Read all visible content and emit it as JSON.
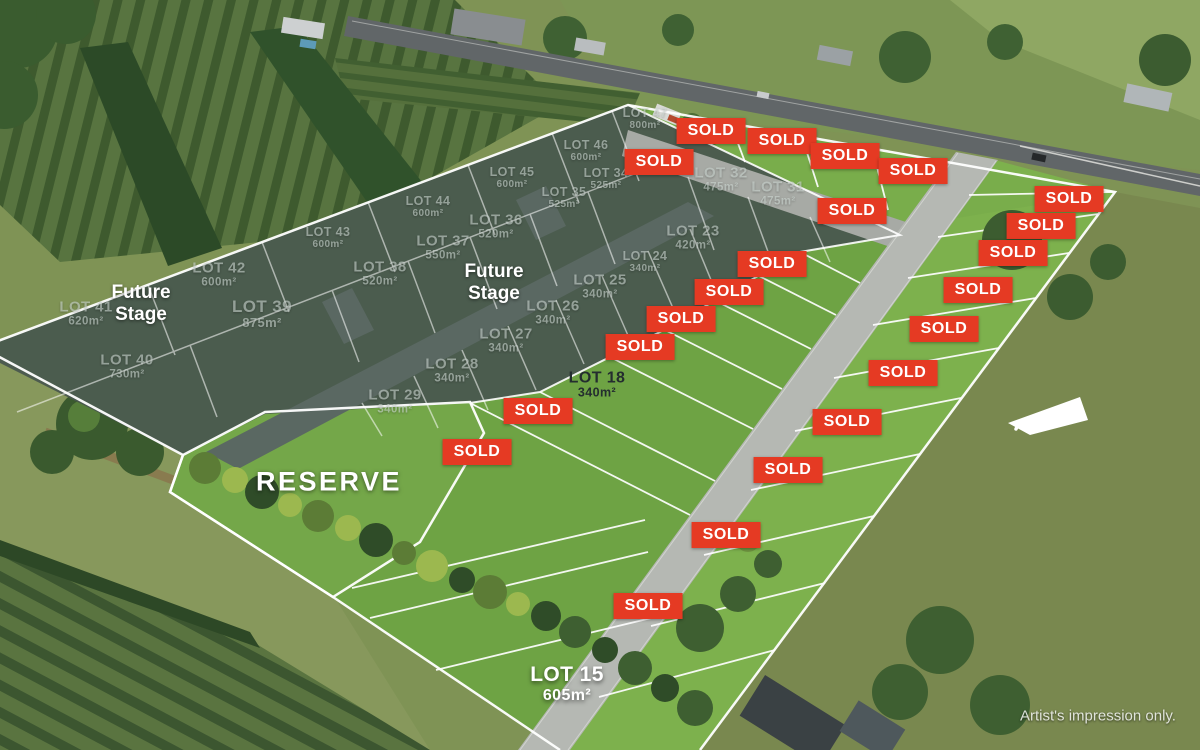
{
  "credit": "Artist's impression only.",
  "sold_label": "SOLD",
  "sold_badge_count": 22,
  "reserve_label": "RESERVE",
  "future_stage_label": "Future Stage",
  "colors": {
    "sold_badge": "#e53a23",
    "future_stage_overlay": "#49574f",
    "stage_grass": "#6ea344",
    "mown_lot_grass": "#7db14d",
    "internal_road": "#b5b8b3",
    "boundary_line": "#ffffff"
  },
  "lots": [
    {
      "name": "LOT 47",
      "area": "800m²"
    },
    {
      "name": "LOT 46",
      "area": "600m²"
    },
    {
      "name": "LOT 45",
      "area": "600m²"
    },
    {
      "name": "LOT 44",
      "area": "600m²"
    },
    {
      "name": "LOT 43",
      "area": "600m²"
    },
    {
      "name": "LOT 42",
      "area": "600m²"
    },
    {
      "name": "LOT 41",
      "area": "620m²"
    },
    {
      "name": "LOT 40",
      "area": "730m²"
    },
    {
      "name": "LOT 39",
      "area": "875m²"
    },
    {
      "name": "LOT 38",
      "area": "520m²"
    },
    {
      "name": "LOT 37",
      "area": "550m²"
    },
    {
      "name": "LOT 36",
      "area": "520m²"
    },
    {
      "name": "LOT 35",
      "area": "525m²"
    },
    {
      "name": "LOT 34",
      "area": "525m²"
    },
    {
      "name": "LOT 32",
      "area": "475m²"
    },
    {
      "name": "LOT 31",
      "area": "475m²"
    },
    {
      "name": "LOT 23",
      "area": "420m²"
    },
    {
      "name": "LOT 24",
      "area": "340m²"
    },
    {
      "name": "LOT 25",
      "area": "340m²"
    },
    {
      "name": "LOT 26",
      "area": "340m²"
    },
    {
      "name": "LOT 27",
      "area": "340m²"
    },
    {
      "name": "LOT 28",
      "area": "340m²"
    },
    {
      "name": "LOT 29",
      "area": "340m²"
    },
    {
      "name": "LOT 18",
      "area": "340m²"
    },
    {
      "name": "LOT 15",
      "area": "605m²"
    }
  ]
}
